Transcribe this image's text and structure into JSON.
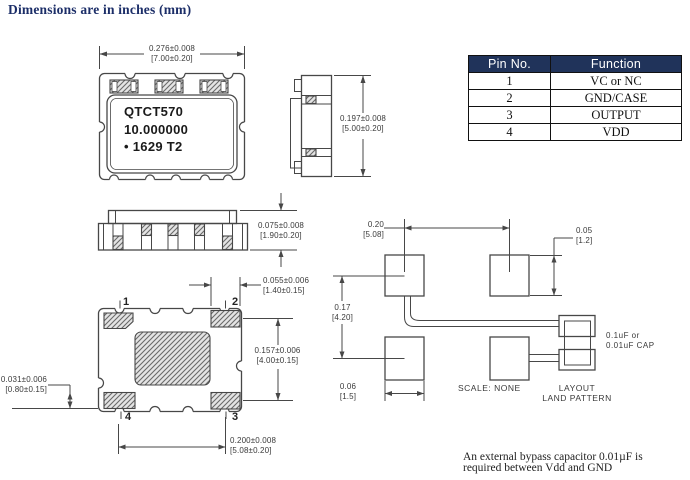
{
  "title": "Dimensions are in inches (mm)",
  "pin_table": {
    "headers": [
      "Pin No.",
      "Function"
    ],
    "rows": [
      [
        "1",
        "VC or NC"
      ],
      [
        "2",
        "GND/CASE"
      ],
      [
        "3",
        "OUTPUT"
      ],
      [
        "4",
        "VDD"
      ]
    ]
  },
  "package_marking": {
    "line1": "QTCT570",
    "line2": "10.000000",
    "line3": "• 1629 T2"
  },
  "pins": {
    "p1": "1",
    "p2": "2",
    "p3": "3",
    "p4": "4"
  },
  "dims": {
    "body_width": {
      "in": "0.276±0.008",
      "mm": "[7.00±0.20]"
    },
    "body_depth": {
      "in": "0.197±0.008",
      "mm": "[5.00±0.20]"
    },
    "body_height": {
      "in": "0.075±0.008",
      "mm": "[1.90±0.20]"
    },
    "pad_width": {
      "in": "0.055±0.006",
      "mm": "[1.40±0.15]"
    },
    "pad_span_v": {
      "in": "0.157±0.006",
      "mm": "[4.00±0.15]"
    },
    "pad_span_h": {
      "in": "0.200±0.008",
      "mm": "[5.08±0.20]"
    },
    "pad_height": {
      "in": "0.031±0.006",
      "mm": "[0.80±0.15]"
    },
    "land_span_h": {
      "in": "0.20",
      "mm": "[5.08]"
    },
    "land_pad_height": {
      "in": "0.05",
      "mm": "[1.2]"
    },
    "land_span_v": {
      "in": "0.17",
      "mm": "[4.20]"
    },
    "land_pad_width": {
      "in": "0.06",
      "mm": "[1.5]"
    }
  },
  "land_pattern": {
    "cap_note_line1": "0.1uF or",
    "cap_note_line2": "0.01uF CAP",
    "scale": "SCALE: NONE",
    "caption_line1": "LAYOUT",
    "caption_line2": "LAND PATTERN"
  },
  "note": {
    "line1": "An external bypass capacitor 0.01µF is",
    "line2": "required between Vdd and GND"
  },
  "colors": {
    "title_navy": "#1c2e68",
    "table_header_bg": "#20335a",
    "line": "#474747"
  }
}
